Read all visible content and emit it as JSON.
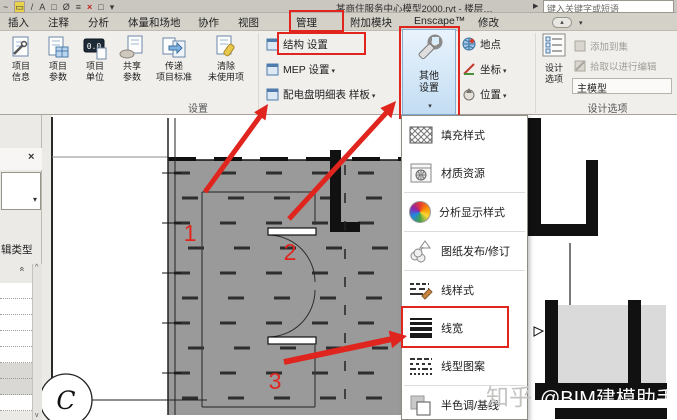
{
  "titlebar": {
    "qat_icons": [
      {
        "name": "spline-icon",
        "glyph": "~"
      },
      {
        "name": "measure-icon",
        "glyph": "▭"
      },
      {
        "name": "align-icon",
        "glyph": "/"
      },
      {
        "name": "text-icon",
        "glyph": "A"
      },
      {
        "name": "default-3d-view-icon",
        "glyph": "□"
      },
      {
        "name": "section-icon",
        "glyph": "Ø"
      },
      {
        "name": "thin-lines-icon",
        "glyph": "≡"
      },
      {
        "name": "close-hidden-windows-icon",
        "glyph": "×"
      },
      {
        "name": "tile-windows-icon",
        "glyph": "□"
      },
      {
        "name": "customize-qat-icon",
        "glyph": "▾"
      }
    ],
    "title": "某商住服务中心模型2000.rvt - 楼层…",
    "search_expander": "▶",
    "search_placeholder": "键入关键字或短语"
  },
  "tabs": {
    "items": [
      "插入",
      "注释",
      "分析",
      "体量和场地",
      "协作",
      "视图",
      "管理",
      "附加模块",
      "Enscape™",
      "修改"
    ],
    "active": "管理",
    "minimize_glyph": "▴"
  },
  "ribbon": {
    "settings_panel_label": "设置",
    "big_buttons": [
      {
        "label": "项目\n信息"
      },
      {
        "label": "项目\n参数"
      },
      {
        "label": "项目\n单位"
      },
      {
        "label": "共享\n参数"
      },
      {
        "label": "传递\n项目标准"
      },
      {
        "label": "清除\n未使用项"
      }
    ],
    "small_buttons": [
      {
        "label": "结构 设置"
      },
      {
        "label": "MEP 设置"
      },
      {
        "label": "配电盘明细表 样板"
      }
    ],
    "other_settings_label": "其他\n设置",
    "location_buttons": [
      {
        "label": "地点"
      },
      {
        "label": "坐标"
      },
      {
        "label": "位置"
      }
    ],
    "design_options": {
      "panel_label": "设计选项",
      "button_label": "设计\n选项",
      "add_to_set": "添加到集",
      "pick_to_edit": "拾取以进行编辑",
      "active_option": "主模型"
    }
  },
  "left_panel": {
    "edit_type_label": "辑类型"
  },
  "menu": {
    "items": [
      {
        "label": "填充样式"
      },
      {
        "label": "材质资源"
      },
      {
        "label": "分析显示样式"
      },
      {
        "label": "图纸发布/修订"
      },
      {
        "label": "线样式"
      },
      {
        "label": "线宽",
        "highlighted": true
      },
      {
        "label": "线型图案"
      },
      {
        "label": "半色调/基线"
      }
    ]
  },
  "plan": {
    "annotations": [
      "1",
      "2",
      "3"
    ],
    "grid_bubble": "C"
  },
  "watermark": {
    "prefix": "知乎",
    "handle": "@BIM建模助手"
  },
  "colors": {
    "annotation_red": "#e0251f",
    "other_settings_highlight": "#cde3f7",
    "plan_fill_gray": "#9a9a9a"
  }
}
